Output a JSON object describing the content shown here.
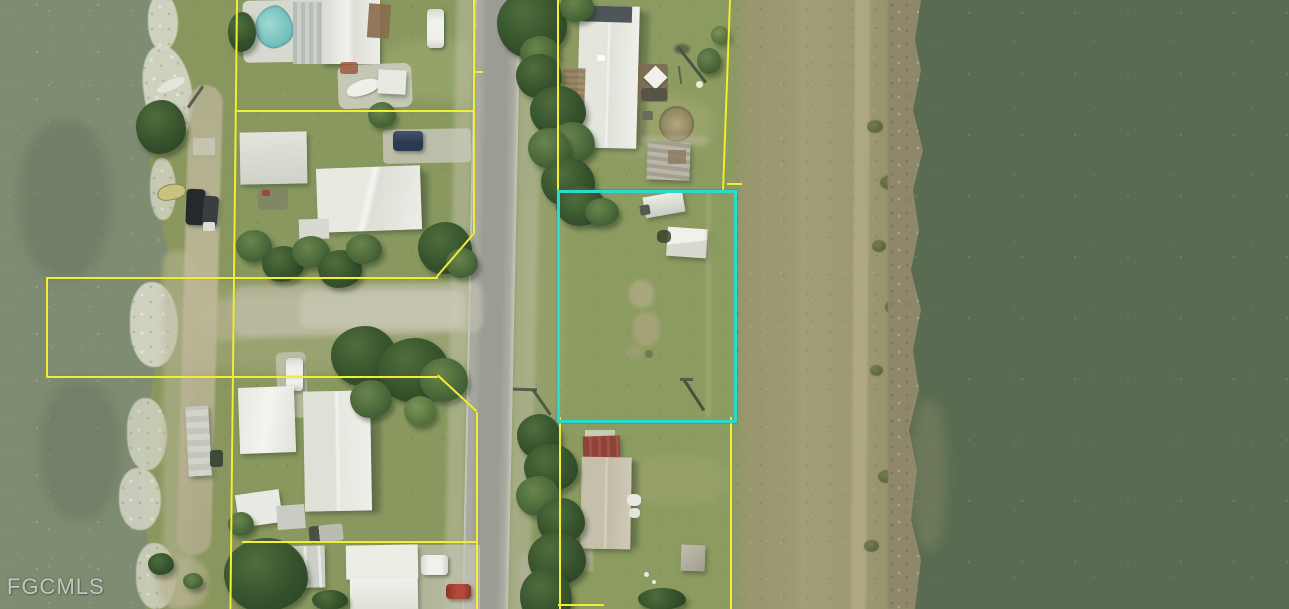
{
  "watermark": {
    "text": "FGCMLS"
  },
  "colors": {
    "boundary": "#f1ed3a",
    "highlight": "#2bd9ce",
    "water-left": "#7e8c72",
    "water-right": "#596b51",
    "grass": "#88985f",
    "road": "#9d9f96",
    "berm": "#9a976e",
    "rock": "#d6d7c8",
    "watermark": "rgba(224,228,220,0.78)"
  }
}
